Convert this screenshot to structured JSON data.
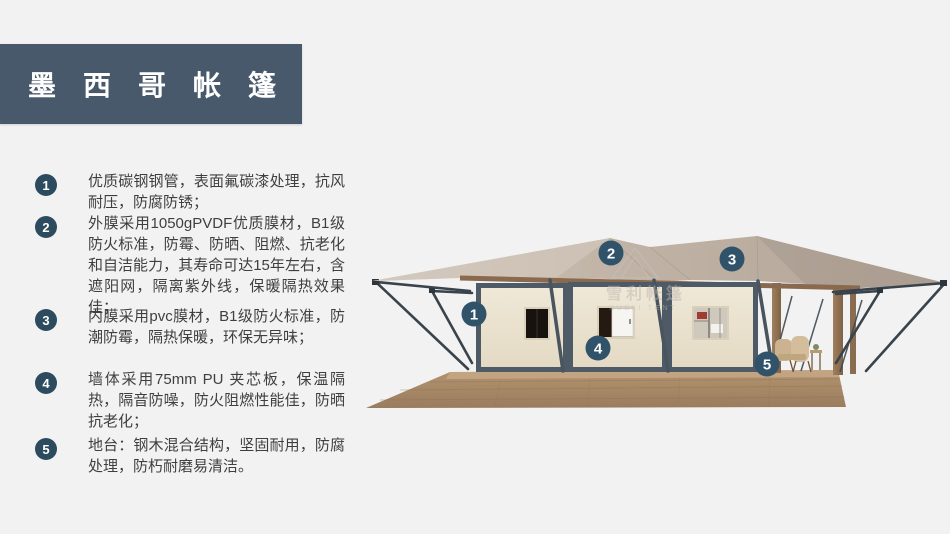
{
  "header": {
    "title": "墨西哥帐篷"
  },
  "features": [
    {
      "num": "1",
      "text": "优质碳钢钢管，表面氟碳漆处理，抗风耐压，防腐防锈；"
    },
    {
      "num": "2",
      "text": "外膜采用1050gPVDF优质膜材，B1级防火标准，防霉、防晒、阻燃、抗老化和自洁能力，其寿命可达15年左右，含遮阳网，隔离紫外线，保暖隔热效果佳；"
    },
    {
      "num": "3",
      "text": "内膜采用pvc膜材，B1级防火标准，防潮防霉，隔热保暖，环保无异味；"
    },
    {
      "num": "4",
      "text": "墙体采用75mm PU 夹芯板，保温隔热，隔音防噪，防火阻燃性能佳，防晒抗老化；"
    },
    {
      "num": "5",
      "text": "地台：钢木混合结构，坚固耐用，防腐处理，防朽耐磨易清洁。"
    }
  ],
  "illustration": {
    "watermark": {
      "cn": "雪利帐篷",
      "en": "XUELI TENT"
    },
    "callouts": [
      {
        "n": "1"
      },
      {
        "n": "2"
      },
      {
        "n": "3"
      },
      {
        "n": "4"
      },
      {
        "n": "5"
      }
    ]
  },
  "theme": {
    "background": "#f2f2f2",
    "banner": "#47596b",
    "bullet_circle": "#2d4b5e",
    "callout_circle": "#31536a",
    "body_text": "#3f3f3f",
    "roof_tan": "#c0b3a6",
    "wall_cream": "#ece4d2",
    "frame_slate": "#4e5a66",
    "wood_brown": "#8d6e52",
    "deck_wood": "#aa8b6d"
  }
}
